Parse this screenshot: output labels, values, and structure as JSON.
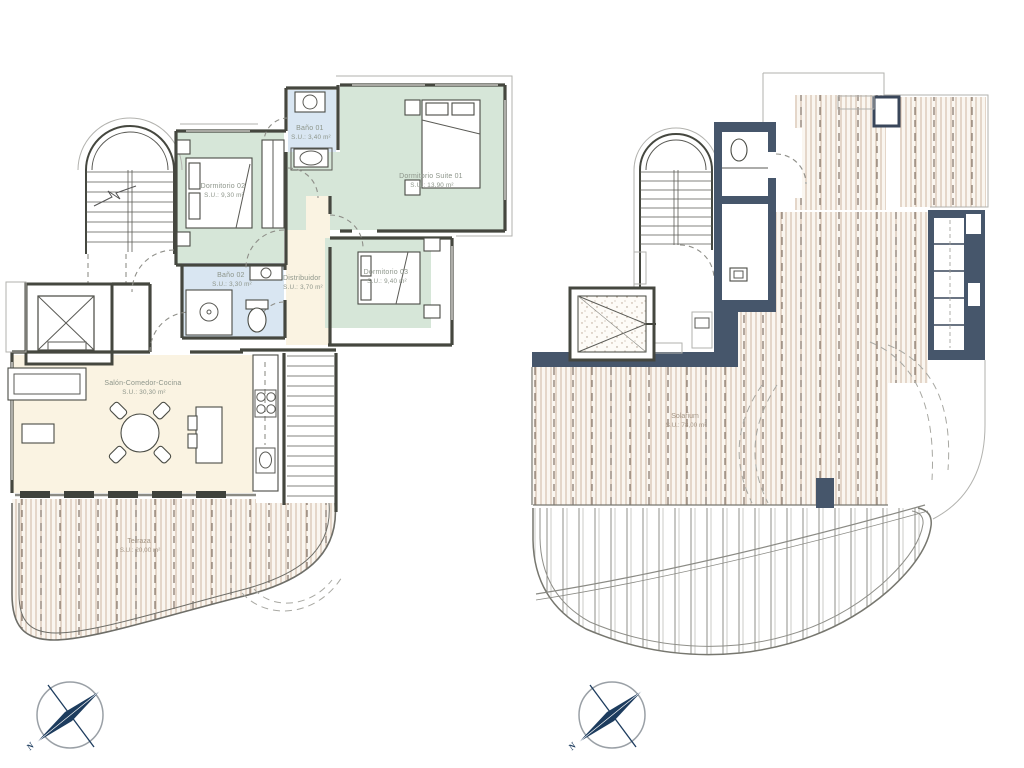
{
  "plans": {
    "left": {
      "name": "apartment-level-plan",
      "rooms": [
        {
          "label": "Dormitorio 02",
          "area": "S.U.: 9,30 m²"
        },
        {
          "label": "Baño 01",
          "area": "S.U.: 3,40 m²"
        },
        {
          "label": "Dormitorio Suite 01",
          "area": "S.U.: 13,90 m²"
        },
        {
          "label": "Baño 02",
          "area": "S.U.: 3,30 m²"
        },
        {
          "label": "Distribuidor",
          "area": "S.U.: 3,70 m²"
        },
        {
          "label": "Dormitorio 03",
          "area": "S.U.: 9,40 m²"
        },
        {
          "label": "Salón-Comedor-Cocina",
          "area": "S.U.: 30,30 m²"
        },
        {
          "label": "Terraza",
          "area": "S.U.: 20,00 m²"
        }
      ]
    },
    "right": {
      "name": "solarium-level-plan",
      "rooms": [
        {
          "label": "Solarium",
          "area": "S.U.: 78,00 m²"
        }
      ]
    }
  },
  "compass": {
    "north_label": "N"
  },
  "colors": {
    "bedroom_green": "#d6e6d8",
    "bathroom_blue": "#d9e6f2",
    "living_cream": "#faf3e2",
    "deck_stripe_tan": "#cdb5a2",
    "dark_wall_navy": "#46566b",
    "compass_navy": "#1d3c5e",
    "wall_gray": "#45473f"
  }
}
